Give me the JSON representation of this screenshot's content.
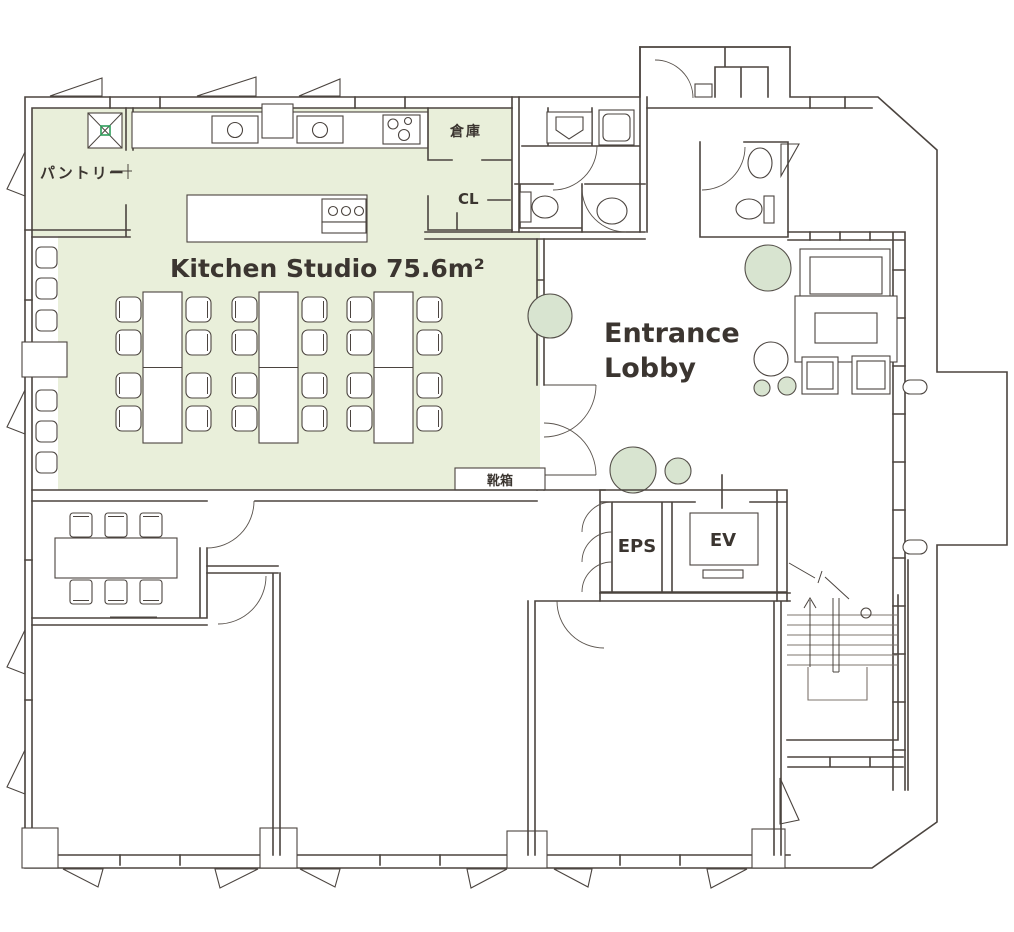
{
  "plan": {
    "title": "Kitchen Studio floor plan",
    "rooms": {
      "kitchen_studio": {
        "label": "Kitchen Studio 75.6m²",
        "area_sqm": "75.6"
      },
      "pantry": {
        "label": "パントリー"
      },
      "storage": {
        "label": "倉庫"
      },
      "closet": {
        "label": "CL"
      },
      "shoe_cabinet": {
        "label": "靴箱"
      },
      "entrance_lobby": {
        "label_line1": "Entrance",
        "label_line2": "Lobby"
      },
      "eps": {
        "label": "EPS"
      },
      "elevator": {
        "label": "EV"
      }
    },
    "colors": {
      "room_fill": "#e9efda",
      "tree_fill": "#d8e4d0",
      "wall_line": "#4b443f",
      "text": "#3b3530",
      "hatch_accent": "#2e9e5b"
    }
  }
}
